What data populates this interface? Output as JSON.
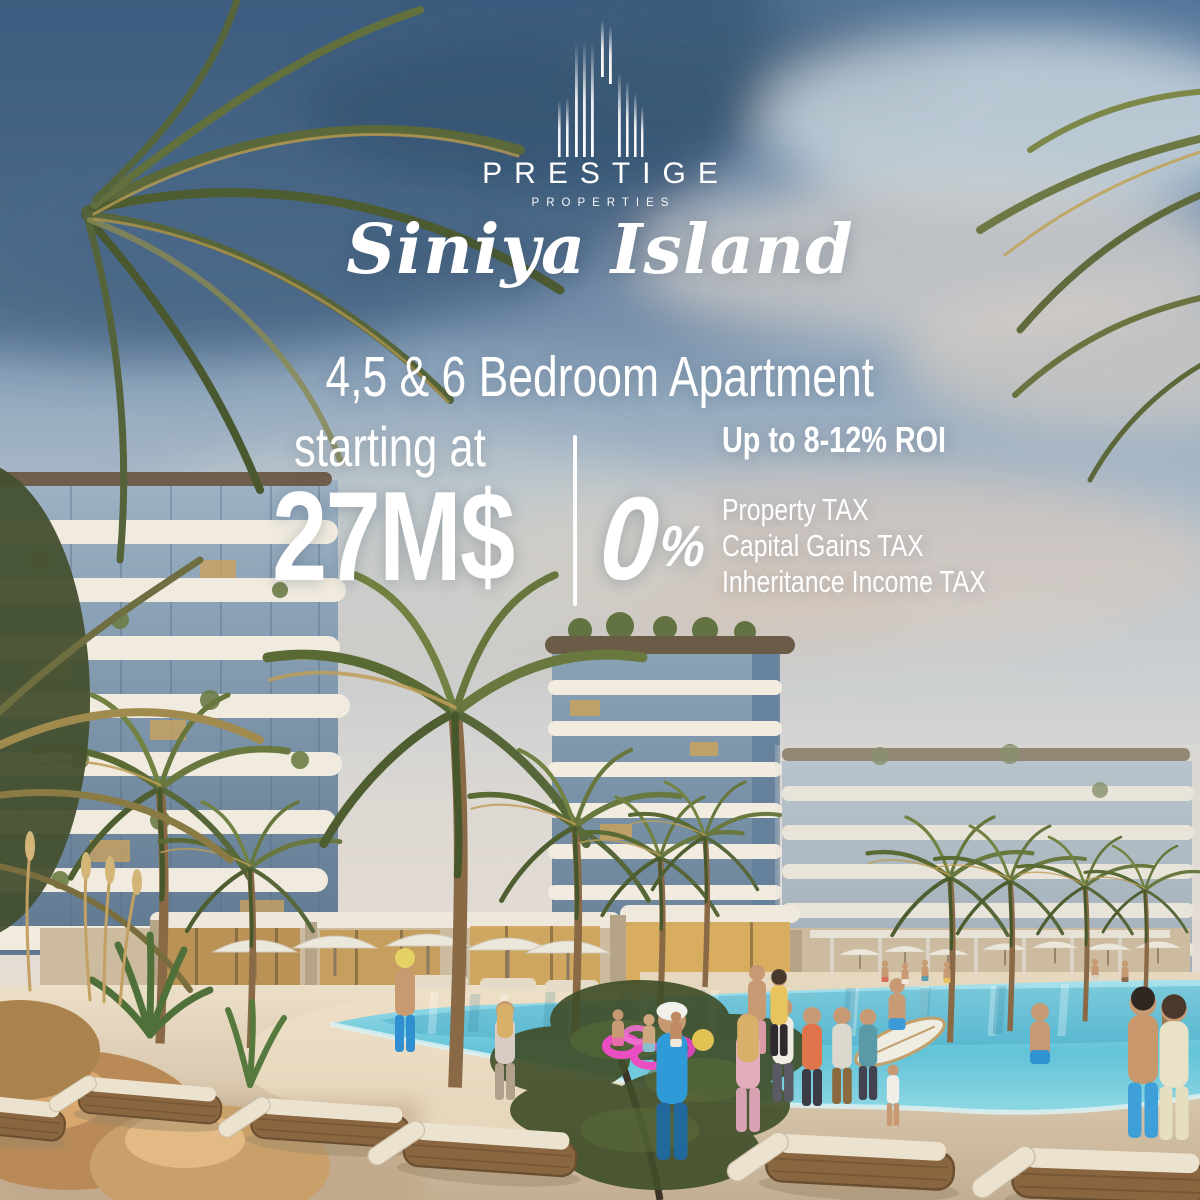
{
  "brand": {
    "name": "PRESTIGE",
    "tagline": "PROPERTIES",
    "project": "Siniya Island"
  },
  "offer": {
    "headline": "4,5 & 6 Bedroom Apartment",
    "price_label": "starting at",
    "price": "27M$",
    "roi": "Up to 8-12% ROI",
    "zero_value": "0",
    "zero_unit": "%",
    "tax_items": [
      "Property TAX",
      "Capital Gains TAX",
      "Inheritance Income TAX"
    ]
  },
  "colors": {
    "text": "#ffffff",
    "sky_dark": "#2d4b6d",
    "sky_light": "#dcd8d2",
    "building_band": "#f0eadf",
    "building_glass": "#7e96ad",
    "pool_water": "#5fc4d9",
    "sand": "#dccab0",
    "palm_green": "#5a6a34",
    "accent_blue": "#2f9ad8",
    "inflatable_pink": "#e94fc2"
  },
  "scene_description": "Beachfront resort render: palm trees, curved apartment buildings, lagoon pool with swimmers, sun loungers on sand"
}
